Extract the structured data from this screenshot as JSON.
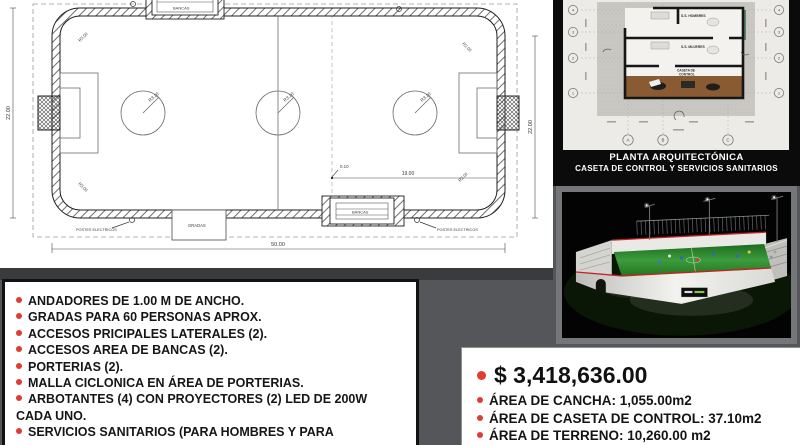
{
  "site_plan": {
    "dims": {
      "width": "50.00",
      "height": "22.00",
      "length_partial": "19.00",
      "offset": "0.10"
    },
    "radii": {
      "circle": "R3.20",
      "corner_outer": "R3.00",
      "corner_inner": "R2.00"
    },
    "labels": {
      "bancas": "BANCAS",
      "gradas": "GRADAS",
      "postes": "POSTES ELECTRICOS"
    }
  },
  "floor_plan": {
    "title_line1": "PLANTA ARQUITECTÓNICA",
    "title_line2": "CASETA DE CONTROL Y SERVICIOS SANITARIOS",
    "rooms": {
      "hombres": "S.S. HOMBRES",
      "mujeres": "S.S. MUJERES",
      "caseta_line1": "CASETA DE",
      "caseta_line2": "CONTROL"
    },
    "grid_letters": [
      "A",
      "B",
      "C"
    ],
    "grid_numbers": [
      "4",
      "3",
      "2",
      "1"
    ]
  },
  "features": {
    "items": [
      "ANDADORES DE 1.00 M DE ANCHO.",
      "GRADAS PARA 60 PERSONAS APROX.",
      "ACCESOS PRICIPALES LATERALES (2).",
      "ACCESOS AREA DE BANCAS (2).",
      "PORTERIAS (2).",
      "MALLA CICLONICA EN ÁREA DE PORTERIAS.",
      "ARBOTANTES  (4) CON PROYECTORES (2) LED DE 200W CADA UNO.",
      "SERVICIOS SANITARIOS (PARA HOMBRES Y PARA"
    ]
  },
  "summary": {
    "price": "$ 3,418,636.00",
    "areas": [
      "ÁREA DE CANCHA: 1,055.00m2",
      "ÁREA DE CASETA DE CONTROL: 37.10m2",
      "ÁREA DE TERRENO: 10,260.00 m2"
    ]
  },
  "colors": {
    "background": "#55565a",
    "accent_red": "#e23b31",
    "panel_black": "#0b0b0b",
    "turf_green": "#2f8f2f"
  }
}
